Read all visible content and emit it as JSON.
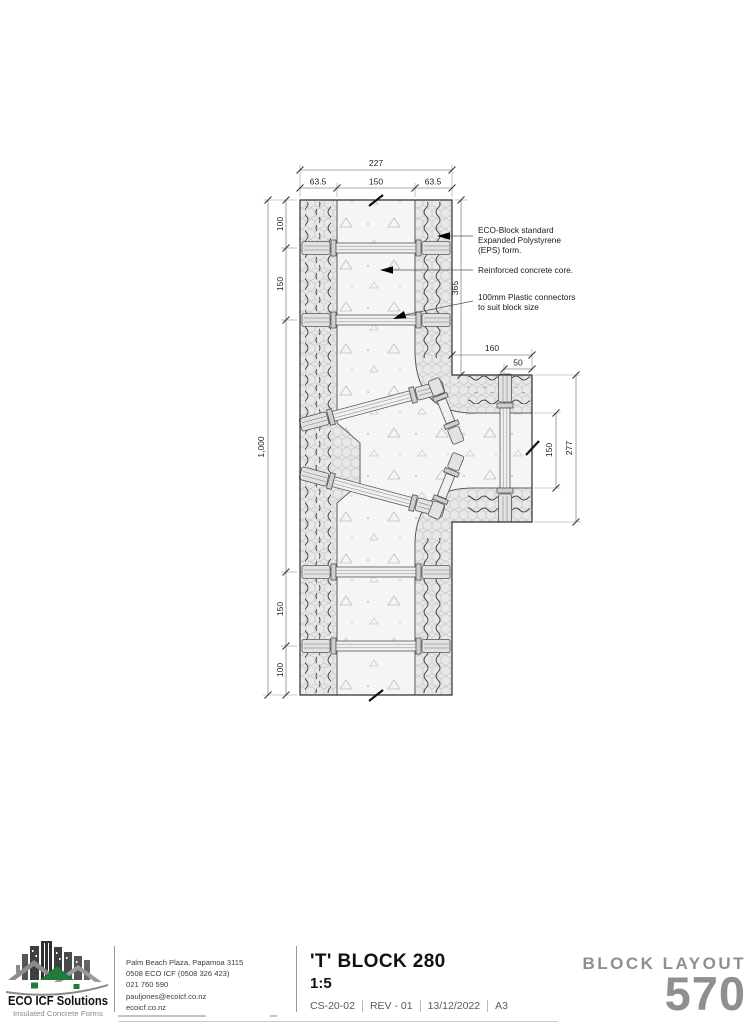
{
  "drawing": {
    "dims": {
      "top_total": "227",
      "top_parts": [
        "63.5",
        "150",
        "63.5"
      ],
      "left": [
        "100",
        "150",
        "1,000",
        "150",
        "100"
      ],
      "right_vertical": "365",
      "branch_top": [
        "160",
        "50"
      ],
      "branch_right": [
        "150",
        "277"
      ]
    },
    "annotations": {
      "eps": [
        "ECO-Block standard",
        "Expanded Polystyrene",
        "(EPS) form."
      ],
      "core": "Reinforced concrete core.",
      "connectors": [
        "100mm Plastic connectors",
        "to suit block size"
      ]
    }
  },
  "title_block": {
    "logo": {
      "name": "ECO ICF Solutions",
      "tagline": "Insulated Concrete Forms"
    },
    "contact": [
      "Palm Beach Plaza, Papamoa 3115",
      "0508 ECO ICF (0508 326 423)",
      "021 760 590",
      "pauljones@ecoicf.co.nz",
      "ecoicf.co.nz"
    ],
    "title": "'T' BLOCK 280",
    "scale": "1:5",
    "sheet": [
      "CS-20-02",
      "REV - 01",
      "13/12/2022",
      "A3"
    ],
    "layout_label": "BLOCK LAYOUT",
    "layout_number": "570"
  },
  "colors": {
    "logo_green": "#217a3c",
    "linework": "#333333",
    "muted_gray": "#8f8f8f"
  }
}
